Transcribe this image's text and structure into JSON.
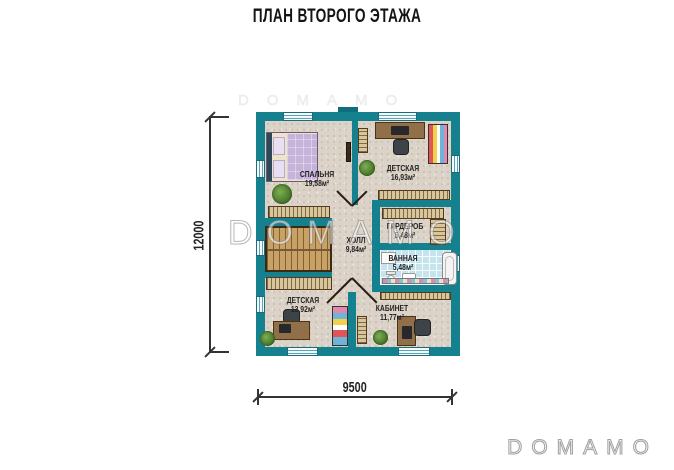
{
  "title": "ПЛАН ВТОРОГО ЭТАЖА",
  "dimensions": {
    "left_total": "12000",
    "bottom_total": "9500"
  },
  "watermark": {
    "center": "DOMAMO",
    "corner": "DOMAMO",
    "tile": "DOMAMO"
  },
  "rooms": [
    {
      "name": "СПАЛЬНЯ",
      "area": "19,58м²"
    },
    {
      "name": "ДЕТСКАЯ",
      "area": "16,93м²"
    },
    {
      "name": "ГАРДЕРОБ",
      "area": "5,48м²"
    },
    {
      "name": "ХОЛЛ",
      "area": "9,84м²"
    },
    {
      "name": "ВАННАЯ",
      "area": "5,48м²"
    },
    {
      "name": "ДЕТСКАЯ",
      "area": "13,92м²"
    },
    {
      "name": "КАБИНЕТ",
      "area": "11,77м²"
    }
  ],
  "colors": {
    "wall": "#15808e",
    "floor": "#dcd3c8",
    "bath_tile": "#c6e4ee",
    "window": "#eaf7fb",
    "wood": "#c8a265",
    "shelving": "#d8c69b",
    "dimension_line": "#333333"
  }
}
